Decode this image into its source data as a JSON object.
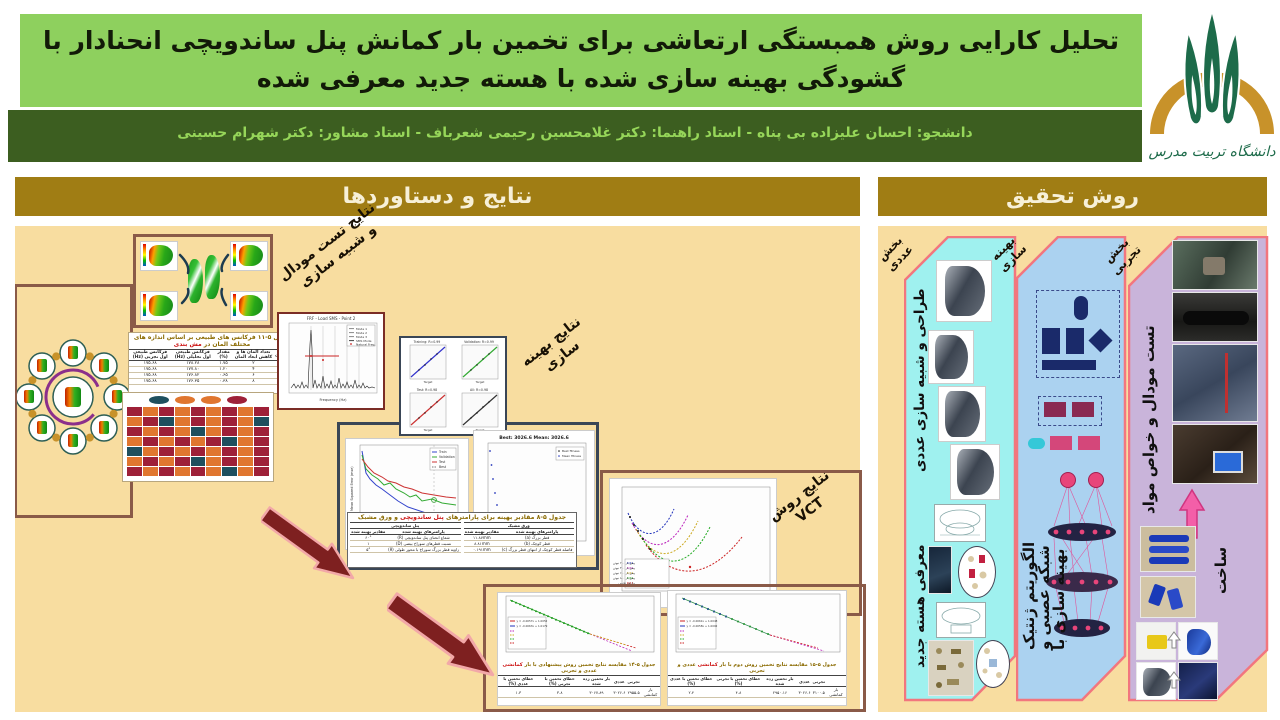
{
  "header": {
    "title_line1": "تحلیل کارایی روش همبستگی ارتعاشی برای تخمین بار کمانش پنل ساندویچی انحنادار با",
    "title_line2": "گشودگی بهینه سازی شده با هسته جدید معرفی شده",
    "byline": "دانشجو: احسان علیزاده بی پناه  -  استاد راهنما: دکتر غلامحسین رحیمی شعرباف  -  استاد مشاور: دکتر شهرام حسینی",
    "logo_text": "دانشگاه تربیت مدرس"
  },
  "sections": {
    "results": "نتایج و دستاوردها",
    "method": "روش تحقیق"
  },
  "results": {
    "labels": {
      "modal1": "نتایج تست مودال",
      "modal2": "و شبیه سازی",
      "opt1": "نتایج بهینه",
      "opt2": "سازی",
      "vct1": "نتایج روش",
      "vct2": "VCT"
    },
    "frf": {
      "title": "FRF - Load SMS - Point 2",
      "xlabel": "Frequency (Hz)",
      "legend": [
        "Mode 1",
        "Mode 2",
        "Mode 3",
        "SMS Mode",
        "Natural Freq."
      ]
    },
    "mesh_table": {
      "cap_pre": "جدول ۵-۱۱ فرکانس های طبیعی بر اساس اندازه های مختلف المان در ",
      "cap_red": "مش بندی",
      "headers": [
        "بارگذاری",
        "تعداد المان ها و کاهش ابعاد المان",
        "مقدار (%)",
        "فرکانس طبیعی اول تحلیلی (Hz)",
        "فرکانس طبیعی اول تجربی (Hz)"
      ],
      "rows": [
        [
          "-",
          "۲",
          "۱.۷۵",
          "۱۷۸.۲۸",
          "۱۷۵.۶۸"
        ],
        [
          "۲۵۰",
          "۴",
          "۱.۲۰",
          "۱۷۷.۸۰",
          "۱۷۵.۶۸"
        ],
        [
          "۲۵۰",
          "۶",
          "۰.۶۵",
          "۱۷۶.۸۲",
          "۱۷۵.۶۸"
        ],
        [
          "۲۵۰",
          "۸",
          "۰.۳۸",
          "۱۷۶.۳۵",
          "۱۷۵.۶۸"
        ]
      ]
    },
    "heatmap": {
      "cell_colors": {
        "R": "#9e2038",
        "O": "#e0762f",
        "T": "#1e4f5e"
      },
      "chips": [
        "#1e4f5e",
        "#e0762f",
        "#e0762f",
        "#9e2038"
      ],
      "pattern": [
        "ROROROROR",
        "ORTOROROT",
        "ROROTOROR",
        "ORORORTOR",
        "TOROROROR",
        "ORORTOROR",
        "ROROROTOR"
      ]
    },
    "regression": {
      "titles": [
        "Training: R=0.99",
        "Validation: R=0.99",
        "Test: R=0.98",
        "All: R=0.98"
      ],
      "xlabel": "Target"
    },
    "mse": {
      "ylabel": "Mean Squared Error (mse)",
      "xlabel": "30 Epochs",
      "legend": [
        "Train",
        "Validation",
        "Test",
        "Best"
      ]
    },
    "ga": {
      "title": "Best: 3026.6 Mean: 3026.6",
      "legend": [
        "Best fitness",
        "Mean fitness"
      ]
    },
    "opt_table": {
      "cap_pre": "جدول ۵-۸ مقادیر بهینه برای پارامترهای ",
      "cap_red": "پنل ساندویچی",
      "cap_post": " و ورق مشبک",
      "group_right": "ورق مشبک",
      "group_left": "پنل ساندویچی",
      "col_param": "پارامترهای بهینه شده",
      "col_value": "مقادیر بهینه شده",
      "rows_right": [
        [
          "قطر بزرگ (a)",
          "۱۱.۸۷mm"
        ],
        [
          "قطر کوچک (b)",
          "۸.۸۱mm"
        ],
        [
          "فاصله قطر کوچک از انتهای قطر بزرگ (c)",
          "۰.۱۹۱mm"
        ]
      ],
      "rows_left": [
        [
          "شعاع انحنای پنل ساندویچی (R)",
          "۶۰°"
        ],
        [
          "نسبت قطرهای سوراخ بیضی (D)",
          "۱"
        ],
        [
          "زاویه قطر بزرگ سوراخ با محور طولی (θ)",
          "۵°"
        ]
      ]
    },
    "vct_curves": {
      "legend": [
        "پیش بار ۲۰۰ نیوتن",
        "پیش بار ۴۰۰ نیوتن",
        "پیش بار ۶۰۰ نیوتن",
        "پیش بار ۸۰۰ نیوتن",
        "برازش تجربی"
      ]
    },
    "vct_left": {
      "formula1": "y = -0.0057x + 1.0052",
      "formula2": "y = -0.0063x + 1.0179",
      "cap_pre": "جدول ۵-۱۴ مقایسه نتایج تخمین روش پیشنهادی با بار ",
      "cap_red": "کمانشی",
      "cap_post": " عددی و تجربی",
      "headers": [
        "",
        "تجربی",
        "عددی",
        "بار تخمین زده شده",
        "خطای تخمین با تجربی (%)",
        "خطای تخمین با عددی (%)"
      ],
      "row": [
        "بار کمانشی",
        "۲۹۵۵.۵",
        "۳۰۲۶.۶",
        "۳۰۶۷.۸۹",
        "۳.۸",
        "۱.۳"
      ]
    },
    "vct_right": {
      "formula1": "y = -0.0061x + 1.0048",
      "formula2": "y = -0.0058x + 1.0092",
      "cap_pre": "جدول ۵-۱۵ مقایسه نتایج تخمین روش دوم با بار ",
      "cap_red": "کمانشی",
      "cap_post": " عددی و تجربی",
      "headers": [
        "",
        "تجربی",
        "عددی",
        "بار تخمین زده شده",
        "خطای تخمین با تجربی (%)",
        "خطای تخمین با عددی (%)"
      ],
      "row": [
        "بار کمانشی",
        "۳۱۰۰.۵",
        "۳۰۲۶.۶",
        "۲۹۵۰.۱۶",
        "۴.۸",
        "۲.۴"
      ]
    }
  },
  "method": {
    "numeric": {
      "corner1": "بخش",
      "corner2": "عددی",
      "label_top": "طراحی و شبیه سازی عددی",
      "label_bottom": "معرفی هسته جدید"
    },
    "optim": {
      "corner1": "بهینه",
      "corner2": "سازی",
      "label_l1": "بهینه سازی با",
      "label_l2": "شبکه عصبی و",
      "label_l3": "الگوریتم ژنتیک"
    },
    "exper": {
      "corner1": "بخش",
      "corner2": "تجربی",
      "label_top": "تست مودال و خواص مواد",
      "label_bottom": "ساخت"
    }
  },
  "colors": {
    "title_band": "#8ed05e",
    "byline_band": "#3c5e20",
    "section_header": "#a07d14",
    "content_bg": "#f8dda0",
    "panel_numeric": "#9ff1ef",
    "panel_optim": "#abd2f0",
    "panel_exper": "#c9b4da",
    "panel_border": "#f2767e",
    "big_arrow": "#7e2020",
    "heat_red": "#9e2038",
    "heat_orange": "#e0762f",
    "heat_teal": "#1e4f5e"
  }
}
